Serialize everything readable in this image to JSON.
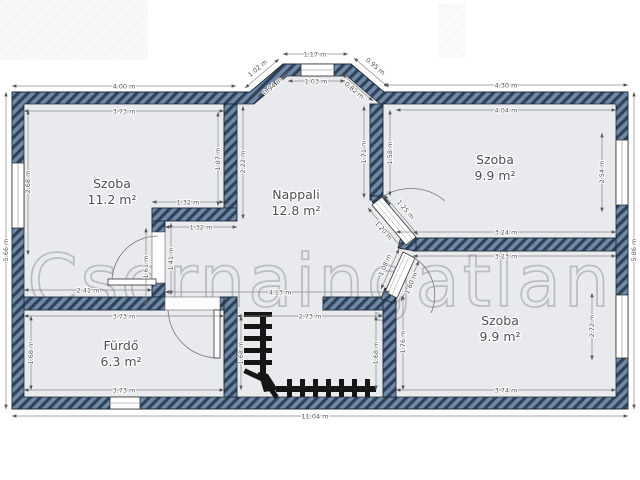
{
  "watermark": "Csornaingatlan",
  "rooms": {
    "szoba_nw": {
      "name": "Szoba",
      "area": "11.2 m²"
    },
    "nappali": {
      "name": "Nappali",
      "area": "12.8 m²"
    },
    "szoba_ne": {
      "name": "Szoba",
      "area": "9.9 m²"
    },
    "furdo": {
      "name": "Fürdő",
      "area": "6.3 m²"
    },
    "szoba_se": {
      "name": "Szoba",
      "area": "9.9 m²"
    }
  },
  "dims": {
    "top_left_outer": "4.00 m",
    "top_left_inner": "3.73 m",
    "bay_top_outer": "1.17 m",
    "bay_top_inner": "1.03 m",
    "bay_left_outer": "1.02 m",
    "bay_left_inner": "0.94 m",
    "bay_right_outer": "0.95 m",
    "bay_right_inner": "0.82 m",
    "top_right_outer": "4.30 m",
    "top_right_inner": "4.04 m",
    "left_height": "5.66 m",
    "left_window": "2.68 m",
    "szoba_nw_right": "1.87 m",
    "nappali_upper_left": "2.22 m",
    "jog_upper": "1.32 m",
    "jog_lower": "1.32 m",
    "door_wall_left": "1.61 m",
    "door_wall_right": "1.41 m",
    "szoba_nw_bottom": "2.41 m",
    "nappali_width": "4.13 m",
    "nappali_wall_outer": "1.71 m",
    "szoba_ne_left": "1.58 m",
    "window_ne": "2.54 m",
    "right_height": "5.86 m",
    "szoba_ne_bottom": "3.24 m",
    "divider_bottom": "3.23 m",
    "furdo_top": "3.73 m",
    "furdo_bottom": "3.73 m",
    "furdo_left": "1.68 m",
    "stair_width": "2.73 m",
    "stair_left": "1.68 m",
    "stair_right": "1.68 m",
    "szoba_se_left": "1.76 m",
    "window_se": "2.72 m",
    "szoba_se_bottom": "3.74 m",
    "total_width": "11.04 m",
    "door_ne_inner": "1.25 m",
    "door_ne_outer": "1.20 m",
    "door_se_inner": "1.08 m",
    "door_se_outer": "1.60 m"
  }
}
